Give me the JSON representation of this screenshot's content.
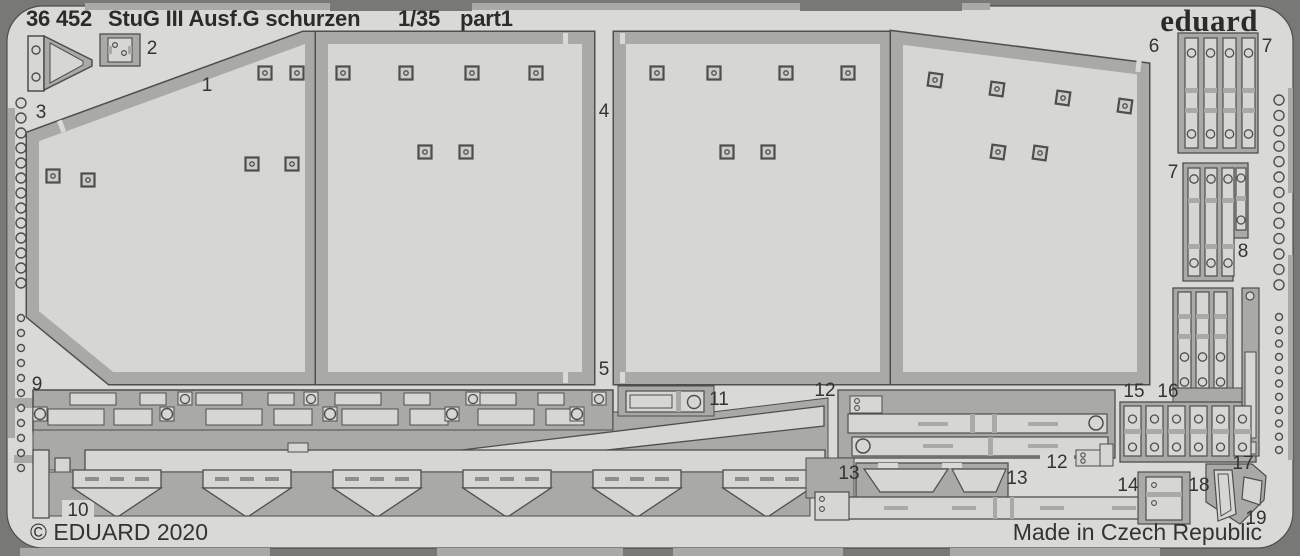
{
  "header": {
    "catalog": "36 452",
    "title": "StuG III Ausf.G schurzen",
    "scale": "1/35",
    "part": "part1",
    "brand": "eduard"
  },
  "footer": {
    "copyright": "© EDUARD 2020",
    "made_in": "Made in Czech Republic"
  },
  "colors": {
    "background": "#787876",
    "sheet": "#d9d9d7",
    "metal": "#a9a9a7",
    "part": "#d6d6d4",
    "outline": "#4e4e4c",
    "text": "#2b2b29"
  },
  "fret": {
    "part_labels": [
      {
        "n": "1",
        "x": 207,
        "y": 86
      },
      {
        "n": "2",
        "x": 152,
        "y": 49
      },
      {
        "n": "3",
        "x": 41,
        "y": 113
      },
      {
        "n": "4",
        "x": 604,
        "y": 112
      },
      {
        "n": "5",
        "x": 604,
        "y": 370
      },
      {
        "n": "6",
        "x": 1154,
        "y": 47
      },
      {
        "n": "7",
        "x": 1267,
        "y": 47
      },
      {
        "n": "7",
        "x": 1173,
        "y": 173
      },
      {
        "n": "8",
        "x": 1243,
        "y": 252
      },
      {
        "n": "9",
        "x": 37,
        "y": 385
      },
      {
        "n": "10",
        "x": 78,
        "y": 511
      },
      {
        "n": "11",
        "x": 719,
        "y": 400
      },
      {
        "n": "12",
        "x": 825,
        "y": 391
      },
      {
        "n": "12",
        "x": 1057,
        "y": 463
      },
      {
        "n": "13",
        "x": 849,
        "y": 474
      },
      {
        "n": "13",
        "x": 1017,
        "y": 479
      },
      {
        "n": "14",
        "x": 1128,
        "y": 486
      },
      {
        "n": "15",
        "x": 1134,
        "y": 392
      },
      {
        "n": "16",
        "x": 1168,
        "y": 392
      },
      {
        "n": "17",
        "x": 1243,
        "y": 464
      },
      {
        "n": "18",
        "x": 1199,
        "y": 486
      },
      {
        "n": "19",
        "x": 1256,
        "y": 519
      }
    ],
    "plates": [
      {
        "label": "3",
        "points": "33,137 304,38 311,38 311,378 111,378 33,314",
        "rivets": [
          [
            265,
            73
          ],
          [
            297,
            73
          ],
          [
            53,
            176
          ],
          [
            88,
            180
          ],
          [
            252,
            164
          ],
          [
            292,
            164
          ]
        ],
        "angle": 0
      },
      {
        "label": "4",
        "points": "322,38 588,38 588,378 322,378",
        "rivets": [
          [
            343,
            73
          ],
          [
            406,
            73
          ],
          [
            472,
            73
          ],
          [
            536,
            73
          ],
          [
            425,
            152
          ],
          [
            466,
            152
          ]
        ],
        "angle": 0
      },
      {
        "label": "5",
        "points": "620,38 886,38 886,378 620,378",
        "rivets": [
          [
            657,
            73
          ],
          [
            714,
            73
          ],
          [
            786,
            73
          ],
          [
            848,
            73
          ],
          [
            727,
            152
          ],
          [
            768,
            152
          ]
        ],
        "angle": 0
      },
      {
        "label": "6",
        "points": "897,38 1143,69 1143,378 897,378",
        "rivets": [
          [
            935,
            80
          ],
          [
            997,
            89
          ],
          [
            1063,
            98
          ],
          [
            1125,
            106
          ],
          [
            998,
            152
          ],
          [
            1040,
            153
          ]
        ],
        "angle": 8
      }
    ],
    "hole_columns": [
      {
        "x": 21,
        "start": 103,
        "step": 15,
        "count": 13,
        "r": 5
      },
      {
        "x": 21,
        "start": 318,
        "step": 15,
        "count": 11,
        "r": 3.5
      },
      {
        "x": 1279,
        "start": 100,
        "step": 15.4,
        "count": 13,
        "r": 5
      },
      {
        "x": 1279,
        "start": 317,
        "step": 13.3,
        "count": 11,
        "r": 3.5
      }
    ],
    "strip_groups": [
      {
        "x": 1185,
        "y": 38,
        "count": 4,
        "w": 13,
        "gap": 6,
        "h": 110,
        "holes": [
          53,
          134
        ],
        "divs": [
          88,
          108
        ]
      },
      {
        "x": 1188,
        "y": 168,
        "count": 3,
        "w": 12,
        "gap": 5,
        "h": 108,
        "holes": [
          179,
          263
        ],
        "divs": [
          198,
          244
        ]
      },
      {
        "x": 1178,
        "y": 292,
        "count": 3,
        "w": 13,
        "gap": 5,
        "h": 96,
        "holes": [
          357,
          382
        ],
        "divs": [
          314,
          334
        ]
      }
    ],
    "clamp_row": {
      "x": 1124,
      "y": 406,
      "count": 6,
      "w": 17,
      "gap": 5,
      "h": 50,
      "holes": [
        419,
        447
      ],
      "div": 429
    },
    "funnel_centers": [
      117,
      247,
      377,
      507,
      637,
      767
    ]
  }
}
